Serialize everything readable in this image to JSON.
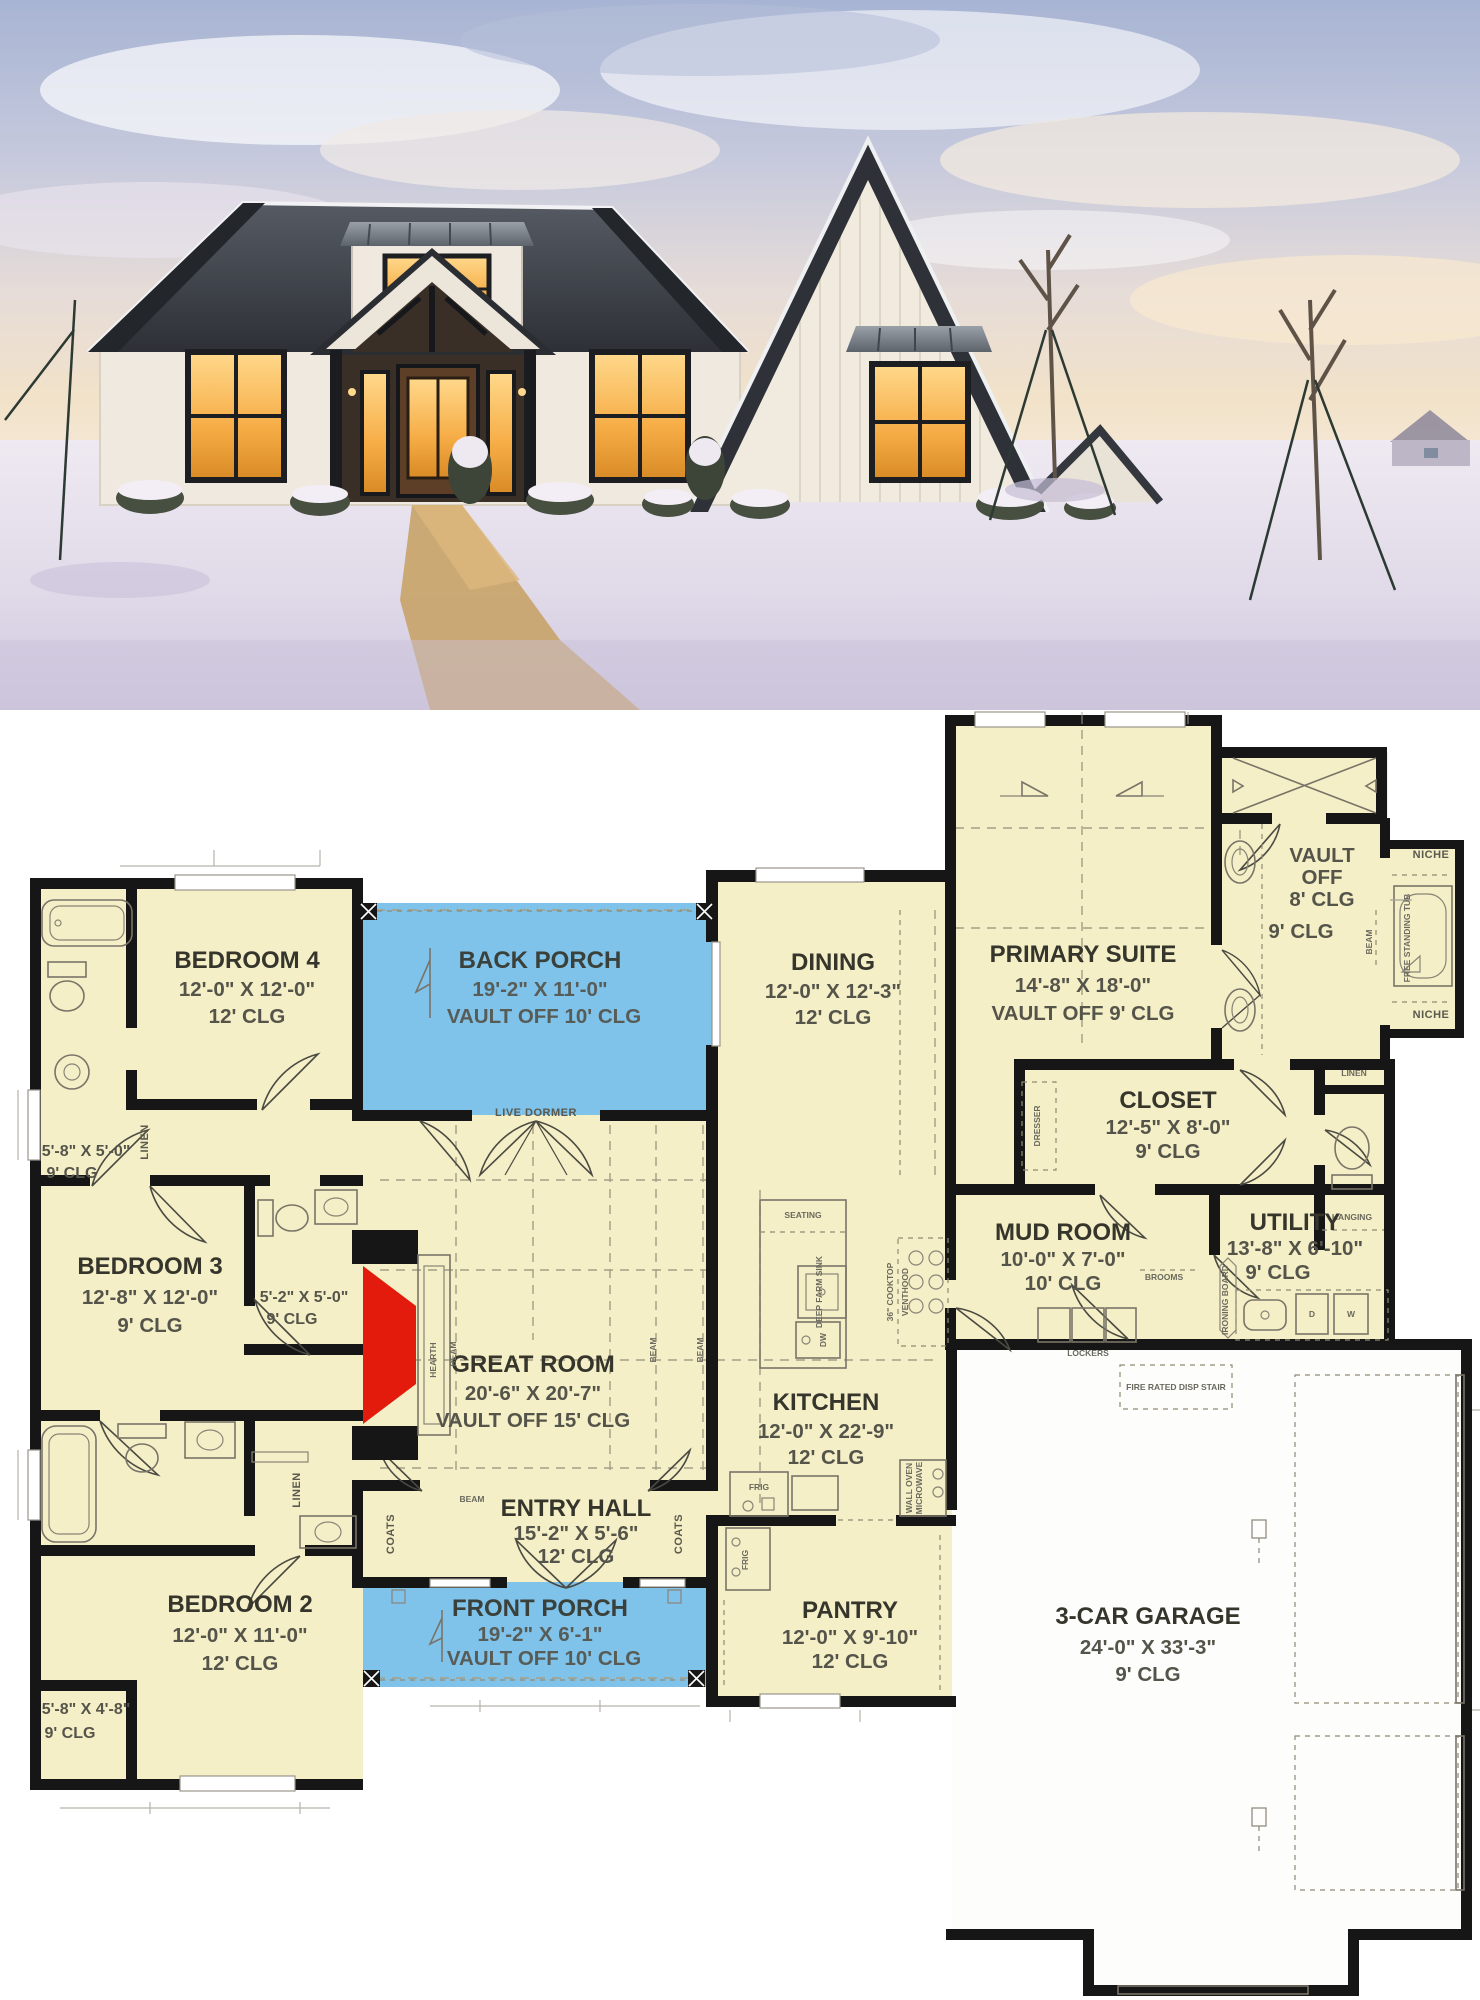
{
  "floor_plan": {
    "rooms": {
      "bedroom4": {
        "name": "BEDROOM 4",
        "dims": "12'-0\" X 12'-0\"",
        "clg": "12' CLG"
      },
      "back_porch": {
        "name": "BACK PORCH",
        "dims": "19'-2\" X 11'-0\"",
        "clg": "VAULT OFF 10' CLG"
      },
      "dining": {
        "name": "DINING",
        "dims": "12'-0\" X 12'-3\"",
        "clg": "12' CLG"
      },
      "primary_suite": {
        "name": "PRIMARY SUITE",
        "dims": "14'-8\" X 18'-0\"",
        "clg": "VAULT OFF 9' CLG"
      },
      "bedroom3": {
        "name": "BEDROOM 3",
        "dims": "12'-8\" X 12'-0\"",
        "clg": "9' CLG"
      },
      "great_room": {
        "name": "GREAT ROOM",
        "dims": "20'-6\" X 20'-7\"",
        "clg": "VAULT OFF 15' CLG"
      },
      "kitchen": {
        "name": "KITCHEN",
        "dims": "12'-0\" X 22'-9\"",
        "clg": "12' CLG"
      },
      "closet": {
        "name": "CLOSET",
        "dims": "12'-5\" X 8'-0\"",
        "clg": "9' CLG"
      },
      "mud_room": {
        "name": "MUD ROOM",
        "dims": "10'-0\" X 7'-0\"",
        "clg": "10' CLG"
      },
      "utility": {
        "name": "UTILITY",
        "dims": "13'-8\" X 6'-10\"",
        "clg": "9' CLG"
      },
      "bedroom2": {
        "name": "BEDROOM 2",
        "dims": "12'-0\" X 11'-0\"",
        "clg": "12' CLG"
      },
      "entry_hall": {
        "name": "ENTRY HALL",
        "dims": "15'-2\" X 5'-6\"",
        "clg": "12' CLG"
      },
      "front_porch": {
        "name": "FRONT PORCH",
        "dims": "19'-2\" X 6'-1\"",
        "clg": "VAULT OFF 10' CLG"
      },
      "pantry": {
        "name": "PANTRY",
        "dims": "12'-0\" X 9'-10\"",
        "clg": "12' CLG"
      },
      "garage": {
        "name": "3-CAR GARAGE",
        "dims": "24'-0\" X 33'-3\"",
        "clg": "9' CLG"
      },
      "bath4": {
        "dims": "5'-8\" X 5'-0\"",
        "clg": "9' CLG"
      },
      "bath3": {
        "dims": "5'-2\" X 5'-0\"",
        "clg": "9' CLG"
      },
      "closet2": {
        "dims": "5'-8\" X 4'-8\"",
        "clg": "9' CLG"
      },
      "primary_bath": {
        "vault1": "VAULT",
        "vault2": "OFF",
        "vault3": "8' CLG",
        "clg": "9' CLG"
      }
    },
    "labels": {
      "live_dormer": "LIVE DORMER",
      "hearth": "HEARTH",
      "beam": "BEAM",
      "coats": "COATS",
      "linen": "LINEN",
      "seating": "SEATING",
      "deep_farm_sink": "DEEP FARM SINK",
      "dw": "DW",
      "cooktop": "36\" COOKTOP",
      "venthood": "VENTHOOD",
      "frig": "FRIG",
      "wall_oven": "WALL OVEN",
      "microwave": "MICROWAVE",
      "dresser": "DRESSER",
      "hanging": "HANGING",
      "ironing_board": "IRONING BOARD",
      "brooms": "BROOMS",
      "lockers": "LOCKERS",
      "d": "D",
      "w": "W",
      "fire_stair": "FIRE RATED DISP STAIR",
      "free_tub": "FREE STANDING TUB",
      "niche": "NICHE"
    },
    "colors": {
      "room_fill": "#f4efc6",
      "porch_fill": "#7fc2ea",
      "wall": "#161616",
      "hearth_red": "#e31b0c",
      "garage_fill": "#fdfdfc"
    }
  }
}
